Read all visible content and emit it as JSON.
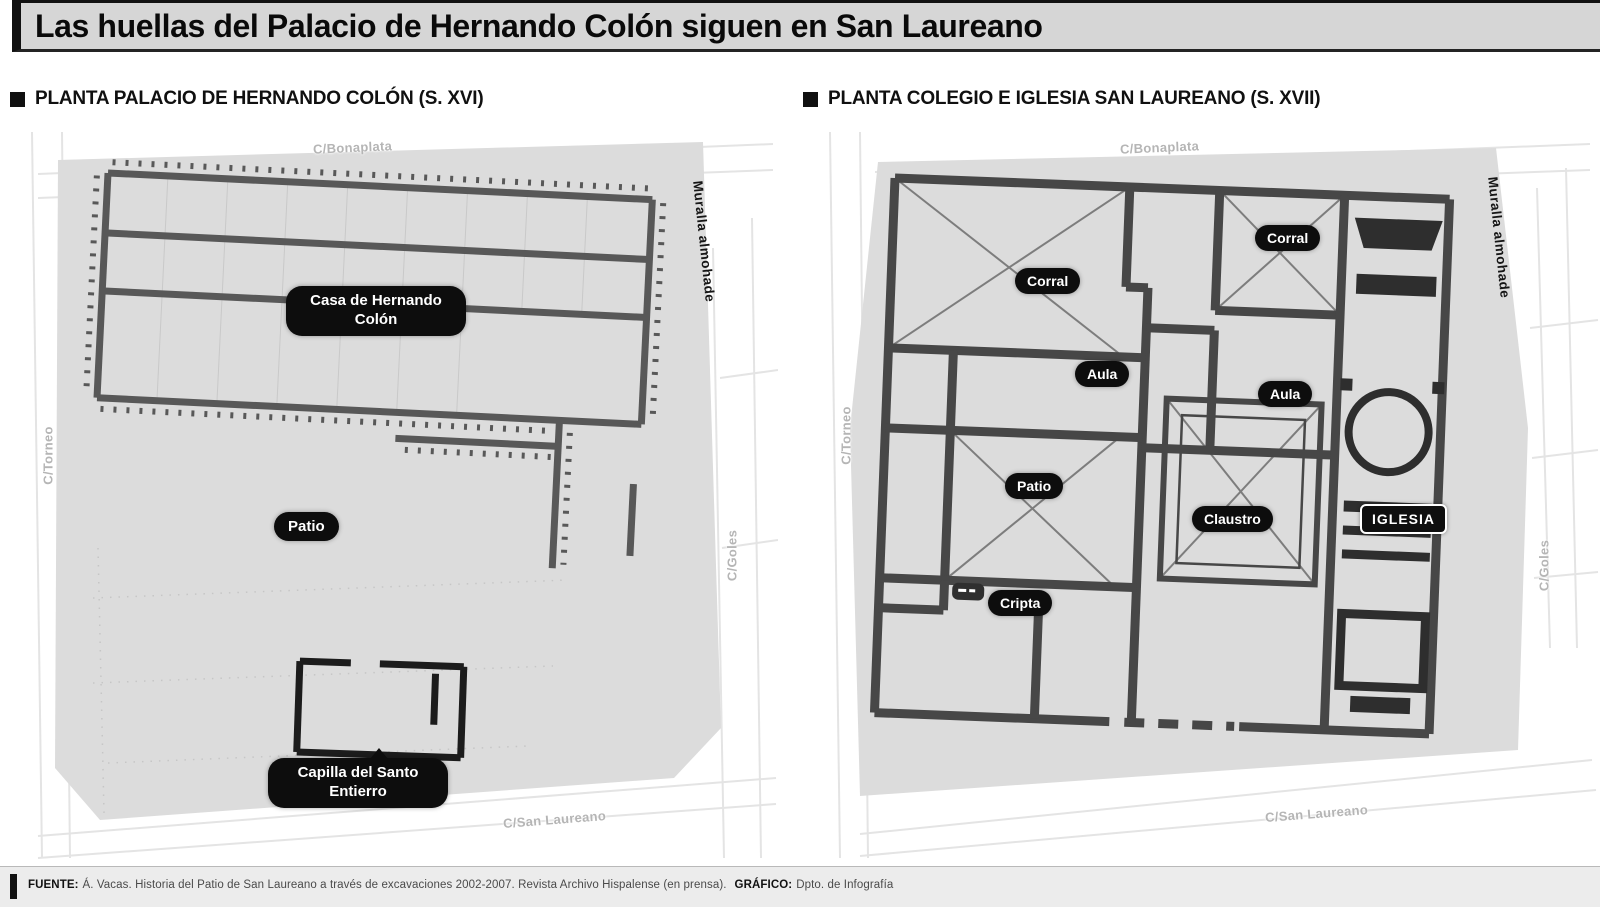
{
  "header": {
    "title": "Las huellas del Palacio de Hernando Colón siguen en San Laureano"
  },
  "panels": [
    {
      "heading": "PLANTA PALACIO DE HERNANDO COLÓN (S. XVI)",
      "labels": {
        "casa": "Casa de Hernando Colón",
        "patio": "Patio",
        "capilla": "Capilla del Santo Entierro"
      },
      "streets": {
        "top": "C/Bonaplata",
        "left": "C/Torneo",
        "right": "C/Goles",
        "bottom": "C/San Laureano",
        "muralla": "Muralla almohade"
      }
    },
    {
      "heading": "PLANTA COLEGIO E IGLESIA SAN LAUREANO (S. XVII)",
      "labels": {
        "corral_left": "Corral",
        "corral_right": "Corral",
        "aula_left": "Aula",
        "aula_right": "Aula",
        "patio": "Patio",
        "claustro": "Claustro",
        "cripta": "Cripta",
        "iglesia": "IGLESIA"
      },
      "streets": {
        "top": "C/Bonaplata",
        "left": "C/Torneo",
        "right": "C/Goles",
        "bottom": "C/San Laureano",
        "muralla": "Muralla almohade"
      }
    }
  ],
  "footer": {
    "source_label": "FUENTE:",
    "source_text": "Á. Vacas. Historia del Patio de San Laureano a través de excavaciones 2002-2007. Revista Archivo Hispalense (en prensa).",
    "credit_label": "GRÁFICO:",
    "credit_text": "Dpto. de Infografía"
  },
  "colors": {
    "plan_fill": "#dcdcdc",
    "wall_dark": "#4a4a4a",
    "label_bg": "#0d0d0d",
    "street_text": "#b5b5b5"
  }
}
